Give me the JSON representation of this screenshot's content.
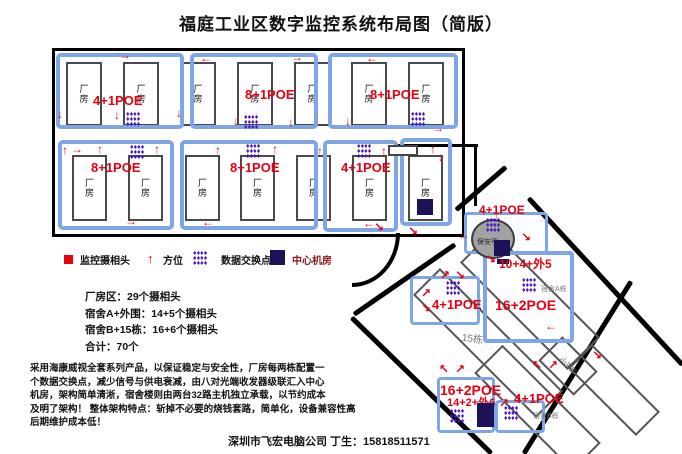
{
  "title": "福庭工业区数字监控系统布局图（简版）",
  "icons": {
    "arrow_up": "↑",
    "arrow_down": "↓",
    "arrow_left": "←",
    "arrow_right": "→",
    "arrow_up_left": "↖",
    "arrow_up_right": "↗",
    "arrow_down_right": "↘",
    "arrow_down_left": "↙",
    "switch_glyph": "♦",
    "camera_glyph": "■"
  },
  "colors": {
    "panel_blue": "#7ea6e6",
    "label_red": "#e60011",
    "switch_purple": "#4813c6",
    "server_navy": "#1d1158",
    "road_black": "#000000"
  },
  "factory": {
    "building_label": "厂房",
    "row1": [
      {
        "poe": "4+1POE"
      },
      {
        "poe": "8+1POE"
      },
      {
        "poe": "8+1POE"
      }
    ],
    "row2": [
      {
        "poe": "8+1POE"
      },
      {
        "poe": "8+1POE"
      },
      {
        "poe": "4+1POE"
      }
    ]
  },
  "legend": {
    "camera": "监控摄相头",
    "direction": "方位",
    "switch": "数据交换点",
    "server": "中心机房"
  },
  "stats": {
    "line1": "厂房区：29个摄相头",
    "line2": "宿舍A+外围：14+5个摄相头",
    "line3": "宿舍B+15栋：16+6个摄相头",
    "line4": "合计：70个"
  },
  "description": {
    "line1": "采用海康威视全套系列产品，以保证稳定与安全性，厂房每两栋配置一",
    "line2": "个数据交换点，减少信号与供电衰减，由八对光端收发器级联汇入中心",
    "line3": "机房，架构简单清淅，宿舍楼则由两台32路主机独立承载，以节约成本",
    "line4": "及明了架构！ 整体架构特点：斩掉不必要的烧钱套路，简单化，设备兼容性高",
    "line5": "后期维护成本低！"
  },
  "footer": "深圳市飞宏电脑公司 丁生：15818511571",
  "right_area": {
    "booth": {
      "poe": "4+1POE",
      "name": "保安亭"
    },
    "gate_box": {
      "poe": "4+1POE"
    },
    "dorm_a": {
      "count": "10+4+外5",
      "poe": "16+2POE",
      "name": "宿舍A栋"
    },
    "building_15": "15栋",
    "small_house": "小平房",
    "dorm_b": {
      "poe": "16+2POE",
      "count": "14+2+外6",
      "name": "宿舍B栋"
    },
    "dorm_b_gate": {
      "poe": "4+1POE"
    }
  }
}
